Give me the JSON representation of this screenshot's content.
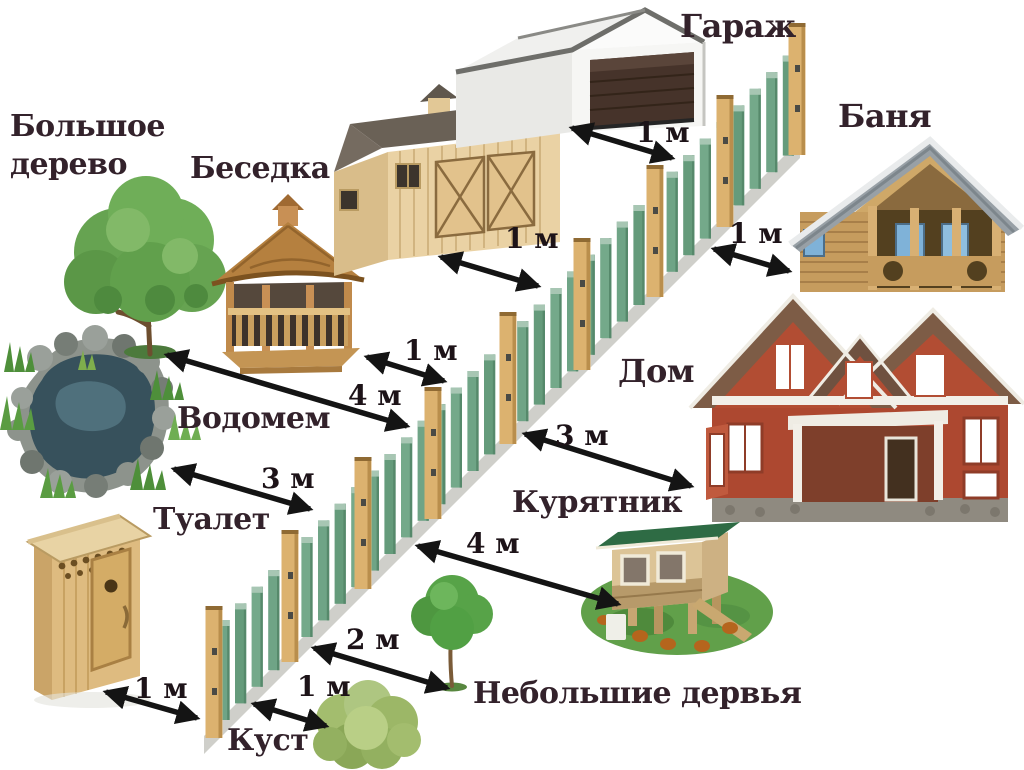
{
  "diagram": {
    "background": "#ffffff",
    "labels": {
      "big_tree": "Большое дерево",
      "gazebo": "Беседка",
      "garage": "Гараж",
      "banya": "Баня",
      "house": "Дом",
      "pond": "Водомем",
      "toilet": "Туалет",
      "chicken_coop": "Курятник",
      "bush": "Куст",
      "small_trees": "Небольшие дервья"
    },
    "measurements": {
      "garage_to_fence": "1 м",
      "shed_to_fence": "1 м",
      "gazebo_to_fence": "1 м",
      "big_tree_to_fence": "4 м",
      "fence_to_banya": "1 м",
      "pond_to_fence": "3 м",
      "fence_to_house": "3 м",
      "toilet_to_fence": "1 м",
      "fence_to_chicken_coop": "4 м",
      "fence_to_bush": "1 м",
      "fence_to_small_trees": "2 м"
    },
    "colors": {
      "text": "#33222b",
      "arrow": "#141414",
      "fence_picket": "#6fa486",
      "fence_post": "#dcb26f",
      "rail": "#cfcfca"
    }
  }
}
